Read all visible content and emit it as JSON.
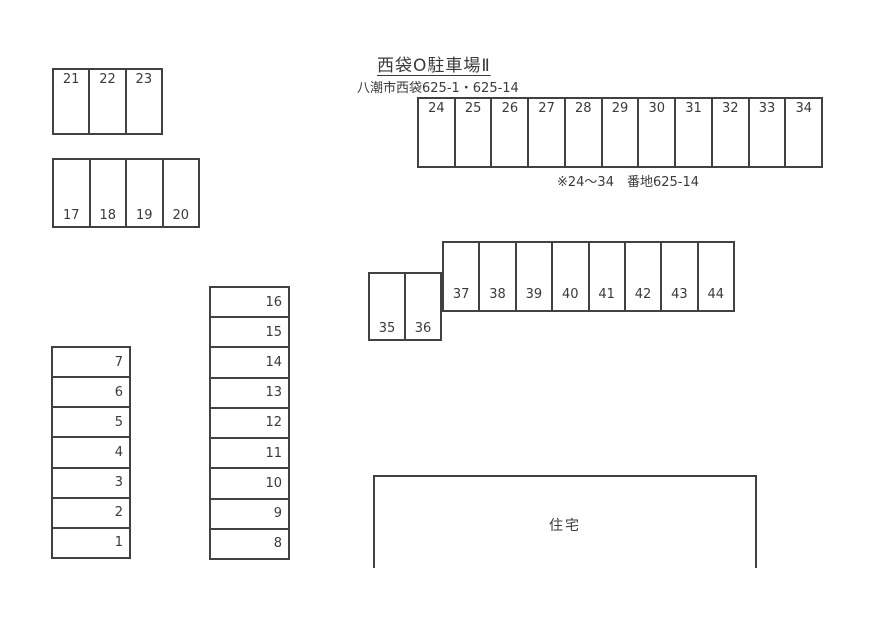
{
  "title": "西袋O駐車場Ⅱ",
  "address": "八潮市西袋625-1・625-14",
  "note": "※24～34　番地625-14",
  "house": {
    "label": "住宅"
  },
  "colors": {
    "line": "#414141",
    "text": "#3a3a3a",
    "background": "#ffffff"
  },
  "blocks": {
    "block_21_23": {
      "spots": [
        "21",
        "22",
        "23"
      ]
    },
    "block_17_20": {
      "spots": [
        "17",
        "18",
        "19",
        "20"
      ]
    },
    "row_24_34": {
      "spots": [
        "24",
        "25",
        "26",
        "27",
        "28",
        "29",
        "30",
        "31",
        "32",
        "33",
        "34"
      ]
    },
    "block_35_36": {
      "spots": [
        "35",
        "36"
      ]
    },
    "row_37_44": {
      "spots": [
        "37",
        "38",
        "39",
        "40",
        "41",
        "42",
        "43",
        "44"
      ]
    },
    "stack_1_7": {
      "spots": [
        "7",
        "6",
        "5",
        "4",
        "3",
        "2",
        "1"
      ]
    },
    "stack_8_16": {
      "spots": [
        "16",
        "15",
        "14",
        "13",
        "12",
        "11",
        "10",
        "9",
        "8"
      ]
    }
  }
}
